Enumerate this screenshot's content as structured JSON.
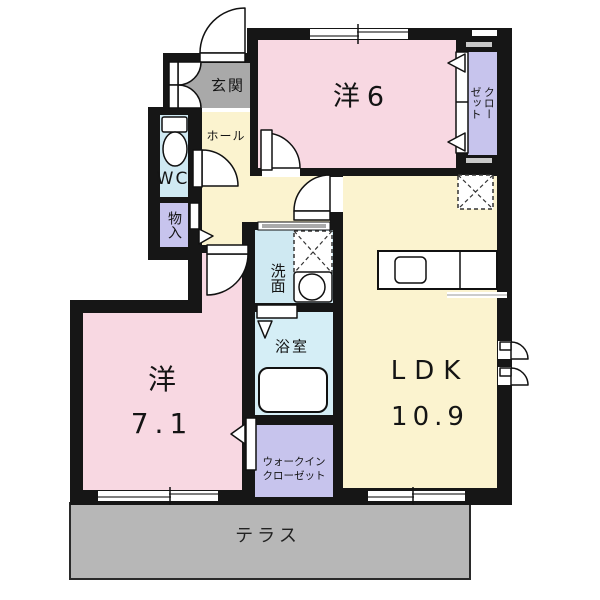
{
  "rooms": {
    "genkan": {
      "label": "玄関"
    },
    "hall": {
      "label": "ホール"
    },
    "wc": {
      "label": "WC"
    },
    "storage": {
      "label": "物入"
    },
    "western6": {
      "label": "洋6"
    },
    "closet": {
      "lines": [
        "クロー",
        "ゼット"
      ]
    },
    "washroom": {
      "label": "洗面"
    },
    "bathroom": {
      "label": "浴室"
    },
    "walkin": {
      "lines": [
        "ウォークイン",
        "クローゼット"
      ]
    },
    "western71": {
      "lines": [
        "洋",
        "7.1"
      ]
    },
    "ldk": {
      "lines": [
        "LDK",
        "10.9"
      ]
    },
    "terrace": {
      "label": "テラス"
    }
  },
  "colors": {
    "wall": "#161616",
    "room_pink": "#f8d8e2",
    "room_yellow": "#fbf3cf",
    "room_blue": "#cfe9f2",
    "room_bath": "#d5eef6",
    "room_purple": "#c7c4ed",
    "genkan_gray": "#a9a9a9",
    "terrace_gray": "#b7b7b7"
  }
}
